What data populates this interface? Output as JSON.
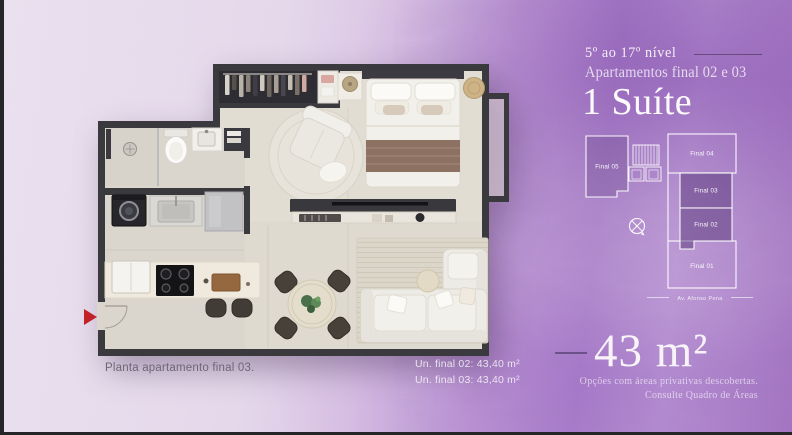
{
  "slide": {
    "header": {
      "levels": "5º ao 17º nível",
      "apartments": "Apartamentos final 02 e 03",
      "suite": "1 Suíte"
    },
    "keyplan": {
      "units": [
        {
          "label": "Final 05",
          "highlighted": false
        },
        {
          "label": "Final 04",
          "highlighted": false
        },
        {
          "label": "Final 03",
          "highlighted": true
        },
        {
          "label": "Final 02",
          "highlighted": true
        },
        {
          "label": "Final 01",
          "highlighted": false
        }
      ],
      "street": "Av. Afonso Pena",
      "compass": "north-compass"
    },
    "area": {
      "value": "43 m²",
      "note_line1": "Opções com áreas privativas descobertas.",
      "note_line2": "Consulte Quadro de Áreas"
    },
    "floorplan": {
      "caption": "Planta apartamento final 03.",
      "unit_area_lines": [
        "Un. final 02: 43,40 m²",
        "Un. final 03: 43,40 m²"
      ],
      "entrance_marker": "red-arrow"
    },
    "palette": {
      "background_light": "#e7dcec",
      "background_purple": "#a678c6",
      "wall": "#3a393e",
      "floor": "#dedacf",
      "keyplan_highlight": "rgba(77,44,110,0.42)",
      "text_light": "#f7f3f8",
      "text_dark": "#6e6675",
      "arrow_red": "#c22127"
    }
  }
}
